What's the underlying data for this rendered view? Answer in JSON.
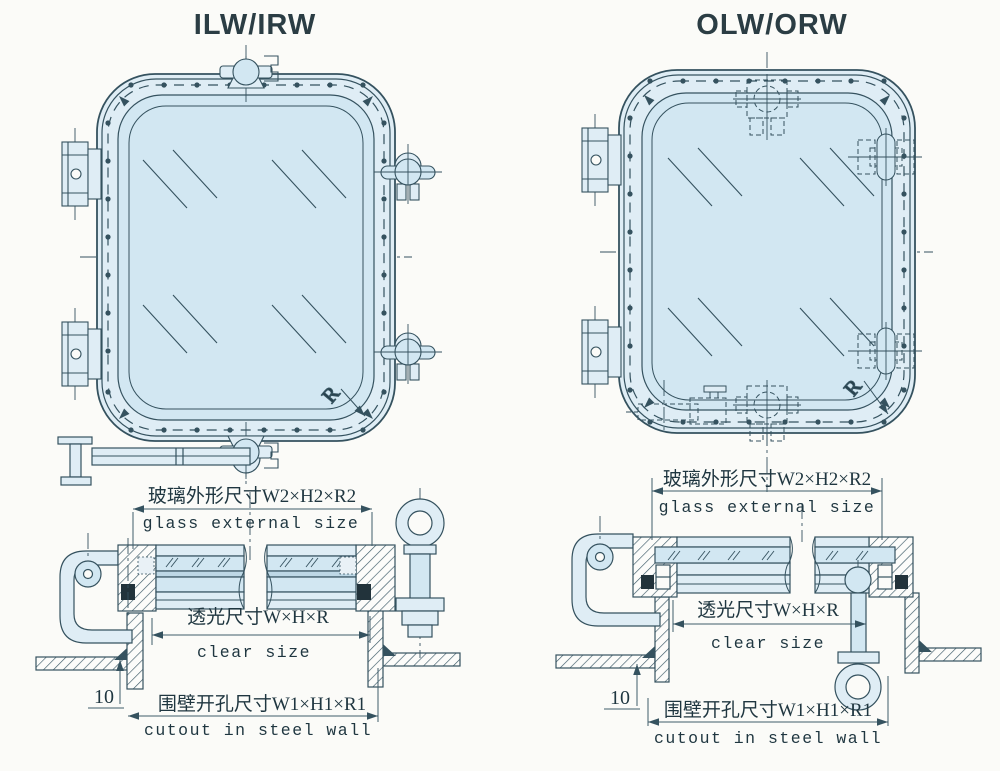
{
  "palette": {
    "background": "#fbfbf8",
    "line": "#35525f",
    "line_soft": "#3f5d6a",
    "glass": "#d2e7f2",
    "frame": "#dfedf5",
    "rubber": "#22333b",
    "text": "#1f3640"
  },
  "left": {
    "title": "ILW/IRW",
    "radius_label": "R",
    "dims": {
      "glass_zh": "玻璃外形尺寸W2×H2×R2",
      "glass_en": "glass external size",
      "clear_zh": "透光尺寸W×H×R",
      "clear_en": "clear size",
      "cutout_zh": "围壁开孔尺寸W1×H1×R1",
      "cutout_en": "cutout in steel wall",
      "wall_offset": "10"
    }
  },
  "right": {
    "title": "OLW/ORW",
    "radius_label": "R",
    "dims": {
      "glass_zh": "玻璃外形尺寸W2×H2×R2",
      "glass_en": "glass external size",
      "clear_zh": "透光尺寸W×H×R",
      "clear_en": "clear size",
      "cutout_zh": "围壁开孔尺寸W1×H1×R1",
      "cutout_en": "cutout in steel wall",
      "wall_offset": "10"
    }
  }
}
